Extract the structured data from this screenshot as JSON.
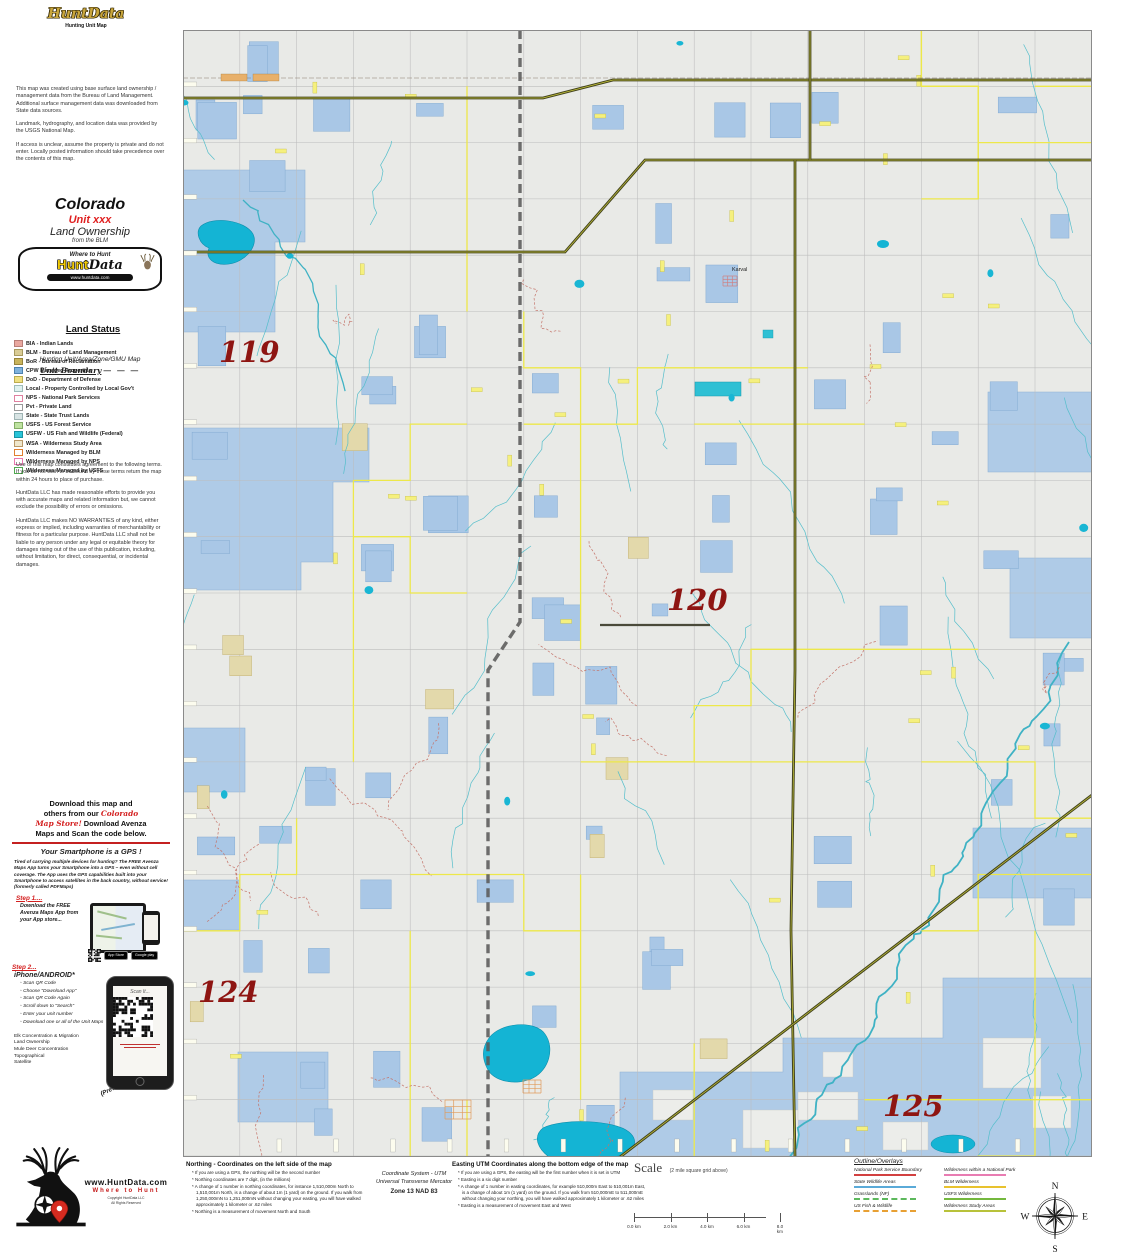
{
  "header_logo": {
    "brand": "HuntData",
    "tagline": "Hunting Unit Map"
  },
  "info_box": {
    "p1": "This map was created using base surface land ownership / management data from the Bureau of Land Management.  Additional surface management data was downloaded from State data sources.",
    "p2": "Landmark, hydrography, and location data was provided by the USGS National Map.",
    "p3": "If access is unclear, assume the property is private and do not enter.  Locally posted information should take precedence over the contents of this map."
  },
  "title_block": {
    "state": "Colorado",
    "unit": "Unit xxx",
    "subtitle": "Land Ownership",
    "source": "from the BLM",
    "banner_top": "Where to Hunt",
    "banner_brand_1": "Hunt",
    "banner_brand_2": "Data",
    "banner_url": "www.huntdata.com",
    "map_type": "Hunting Unit/Area/Zone/GMU Map",
    "unit_boundary_label": "Unit Boundary",
    "unit_boundary_dashes": "— — —"
  },
  "land_status": {
    "title": "Land Status",
    "items": [
      {
        "label": "BIA - Indian Lands",
        "fill": "#E9A8A0",
        "border": "#B97E78"
      },
      {
        "label": "BLM - Bureau of Land Management",
        "fill": "#D9CC96",
        "border": "#A89A60"
      },
      {
        "label": "BoR - Bureau of Reclamation",
        "fill": "#C9B45C",
        "border": "#97843C"
      },
      {
        "label": "CPW Managed Properties",
        "fill": "#7FB2DC",
        "border": "#4D82B0"
      },
      {
        "label": "DoD - Department of Defense",
        "fill": "#EFE081",
        "border": "#BCAC4E"
      },
      {
        "label": "Local - Property Controlled by Local Gov't",
        "fill": "#DFF2F0",
        "border": "#9FBCBA"
      },
      {
        "label": "NPS - National Park Services",
        "fill": "#FFFFFF",
        "border": "#E080A0"
      },
      {
        "label": "Pvt - Private Land",
        "fill": "#FFFFFF",
        "border": "#999999"
      },
      {
        "label": "State - State Trust Lands",
        "fill": "#D8E4E4",
        "border": "#9FB4B4"
      },
      {
        "label": "USFS - US Forest Service",
        "fill": "#BFE3A1",
        "border": "#84AD66"
      },
      {
        "label": "USFW - US Fish and Wildlife (Federal)",
        "fill": "#28C4D8",
        "border": "#1693A4"
      },
      {
        "label": "WSA - Wilderness Study Area",
        "fill": "#EFE7CD",
        "border": "#B89868"
      },
      {
        "label": "Wilderness Managed by BLM",
        "fill": "#FFFFFF",
        "border": "#E08030"
      },
      {
        "label": "Wilderness Managed by NPS",
        "fill": "#FFFFFF",
        "border": "#E878B0"
      },
      {
        "label": "Wilderness Managed by USFS",
        "fill": "#FFFFFF",
        "border": "#50A850"
      }
    ]
  },
  "terms": {
    "p1": "Use of this map constitutes agreement to the following terms.  If you do not wish to be bound by these terms return the map within 24 hours to place of purchase.",
    "p2": "HuntData LLC has made reasonable efforts to provide you with accurate maps and related information but, we cannot exclude the possibility of errors or omissions.",
    "p3": "HuntData LLC makes NO WARRANTIES of any kind, either express or implied, including warranties of merchantability or fitness for a particular purpose.  HuntData LLC shall not be liable to any person under any legal or equitable theory for damages rising out of the use of this publication, including, without limitation, for direct, consequential, or incidental damages."
  },
  "download_promo": {
    "line1": "Download this map and",
    "line2_a": "others from our ",
    "line2_b": "Colorado",
    "line3_a": "Map Store!",
    "line3_b": " Download Avenza",
    "line4": "Maps and Scan the code below.",
    "gps_headline": "Your Smartphone is a GPS !",
    "gps_body": "Tired of carrying multiple devices for hunting? The FREE Avenza Maps App turns your Smartphone into a GPS – even without cell coverage. The App uses the GPS capabilities built into your Smartphone to access satellites in the back country, without service! (formerly called PDFMaps)",
    "step1_label": "Step 1....",
    "step1_text": "Download the FREE Avenza Maps App from your App store...",
    "badge_apple": "App Store",
    "badge_google": "Google play",
    "step2_label": "Step 2...",
    "platforms": "iPhone/ANDROID*",
    "steps": [
      "Scan QR Code",
      "Choose \"Download App\"",
      "Scan QR Code Again",
      "Scroll down to \"Search\"",
      "Enter your unit number",
      "Download one or all of the Unit Maps"
    ],
    "map_list": [
      "Elk Concentration & Migration",
      "Land Ownership",
      "Mule Deer Concentration",
      "Topographical",
      "Satellite"
    ],
    "preview_note": "(Preview every Map)",
    "scan_label": "Scan It..."
  },
  "footer_logo": {
    "url": "www.HuntData.com",
    "tagline": "Where to Hunt",
    "copyright": "Copyright HuntData LLC",
    "rights": "All Rights Reserved"
  },
  "map": {
    "unit_labels": [
      {
        "text": "119",
        "x": 36,
        "y": 332
      },
      {
        "text": "120",
        "x": 484,
        "y": 580
      },
      {
        "text": "124",
        "x": 15,
        "y": 972
      },
      {
        "text": "125",
        "x": 700,
        "y": 1086
      }
    ],
    "towns": [
      {
        "name": "Karval",
        "x": 549,
        "y": 241
      }
    ]
  },
  "bottom_bar": {
    "northing": {
      "title": "Northing - Coordinates on the left side of the map",
      "bullets": [
        "If you are using a GPS, the northing will be the second number",
        "Northing coordinates are 7 digit, (in the millions)",
        "A change of 1 number in northing coordinates, for instance 1,510,000m North to 1,510,001m North, is a change of about 1m (1 yard) on the ground.  If you walk from 1,250,000mN to 1,251,000mN without changing your easting, you will have walked approximately 1 kilometer or .62 miles",
        "Northing is a measurement of movement North and South"
      ]
    },
    "coord_system": {
      "line1": "Coordinate System - UTM",
      "line2": "Universal Transverse Mercator",
      "line3": "Zone 13  NAD 83"
    },
    "easting": {
      "title": "Easting UTM Coordinates along the bottom edge of the map",
      "bullets": [
        "If you are using a GPS, the easting will be the first number when it is set in UTM",
        "Easting is a six digit number",
        "A change of 1 number in easting coordinates, for example 510,000m East to 510,001m East, is a change of about 1m (1 yard) on the ground.  If you walk from 510,000mE to 511,000mE without changing your northing, you will have walked approximately 1 kilometer or .62 miles",
        "Easting is a measurement of movement East and West"
      ]
    },
    "scale": {
      "label": "Scale",
      "note": "(2 mile square grid above)",
      "ticks": [
        "0.0 km",
        "2.0 km",
        "4.0 km",
        "6.0 km",
        "8.0 km"
      ]
    },
    "overlays": {
      "title": "Outline/Overlays",
      "left": [
        {
          "label": "National Park Service Boundary",
          "color": "#D24040",
          "dash": false
        },
        {
          "label": "State Wildlife Areas",
          "color": "#5AAAD8",
          "dash": false
        },
        {
          "label": "Grasslands (NF)",
          "color": "#5CB85C",
          "dash": true
        },
        {
          "label": "US Fish & Wildlife",
          "color": "#E8A034",
          "dash": true
        }
      ],
      "right": [
        {
          "label": "Wilderness within a National Park",
          "color": "#E87CB2",
          "dash": false
        },
        {
          "label": "BLM Wilderness",
          "color": "#E8C22E",
          "dash": false
        },
        {
          "label": "USFS Wilderness",
          "color": "#74B83E",
          "dash": false
        },
        {
          "label": "Wilderness Study Areas",
          "color": "#B8C23A",
          "dash": false
        }
      ]
    },
    "compass": {
      "n": "N",
      "e": "E",
      "s": "S",
      "w": "W"
    }
  }
}
